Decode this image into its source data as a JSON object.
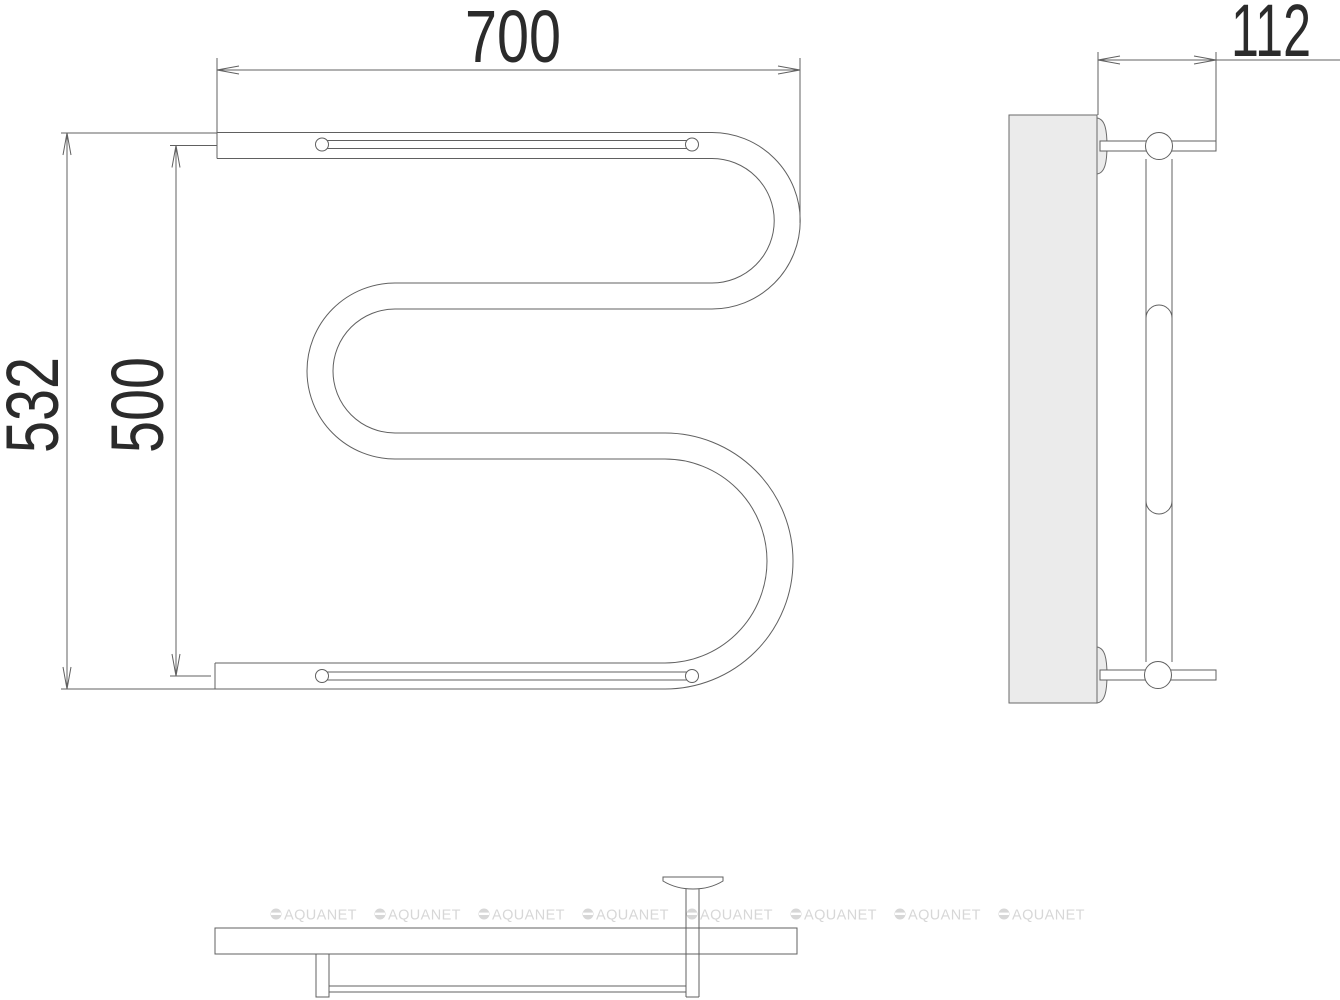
{
  "dimensions": {
    "width": "700",
    "overall_height": "532",
    "center_height": "500",
    "depth": "112"
  },
  "watermark": {
    "text": "AQUANET"
  },
  "colors": {
    "line": "#606060",
    "dimension_text": "#2b2b2b",
    "plate_fill": "#ebebeb",
    "watermark": "#d7d7d7",
    "background": "#ffffff"
  }
}
